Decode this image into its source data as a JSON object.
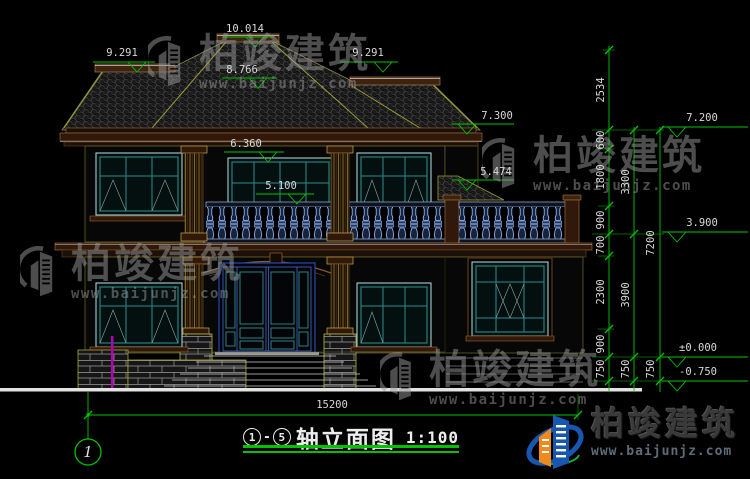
{
  "drawing": {
    "levels": {
      "peak": "10.014",
      "upper_ridge": "8.766",
      "left_ridge": "9.291",
      "right_ridge": "9.291",
      "right_eave": "7.300",
      "balcony_top": "6.360",
      "terrace_roof": "5.474",
      "window_sill": "5.100",
      "floor2_top": "7.200",
      "floor2": "3.900",
      "floor1": "±0.000",
      "site": "-0.750"
    },
    "chains": {
      "inner": [
        "2534",
        "600",
        "1800",
        "900",
        "700",
        "2300",
        "900",
        "750"
      ],
      "middle": [
        "3300",
        "3900",
        "750"
      ],
      "outer": [
        "7200",
        "750"
      ]
    },
    "total_width": "15200",
    "axis_bubble": "1"
  },
  "title": {
    "axis_start": "1",
    "separator": "-",
    "axis_end": "5",
    "text": "轴立面图",
    "scale": "1:100"
  },
  "brand": {
    "name": "柏竣建筑",
    "website": "www.baijunjz.com"
  },
  "colors": {
    "dimension_green": "#00c300",
    "text_white": "#d8d8d8",
    "window_teal": "#1f7070",
    "door_blue": "#4a67d4",
    "cornice_brown": "#9a6436",
    "ridge_olive": "#9a9a3a",
    "baluster_blue": "#9fc0ff",
    "ground_white": "#e2e2e2",
    "logo_blue": "#1857b0",
    "logo_orange": "#f08a1d"
  }
}
